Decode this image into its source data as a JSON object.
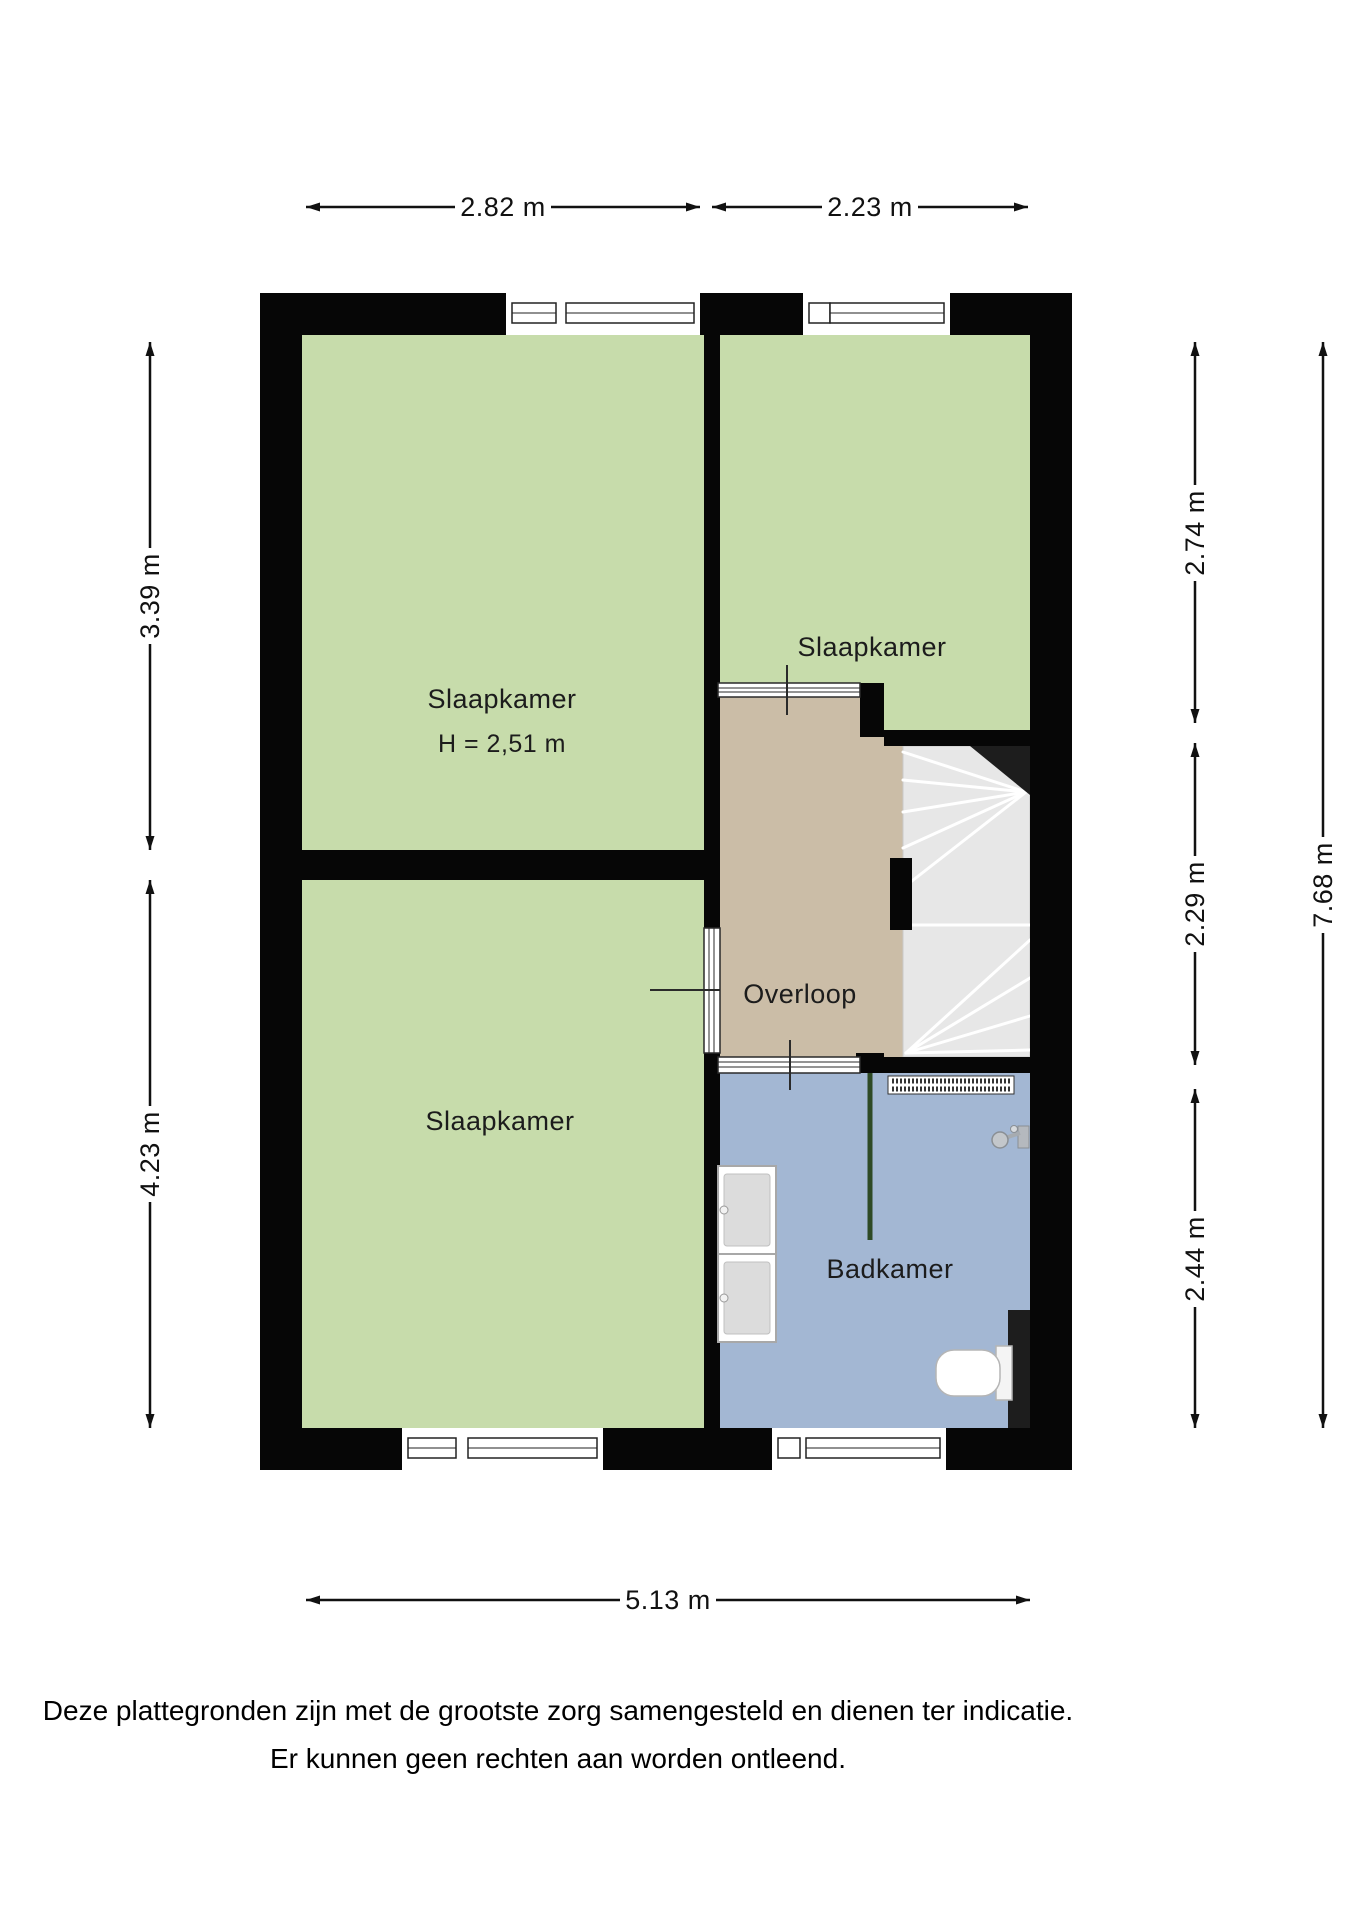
{
  "page": {
    "background_color": "#ffffff"
  },
  "plan": {
    "wall_color": "#060606",
    "rooms": {
      "slaapkamer_top_left": {
        "label": "Slaapkamer",
        "ceiling_height": "H = 2,51 m",
        "floor_color": "#c7dcab"
      },
      "slaapkamer_top_right": {
        "label": "Slaapkamer",
        "floor_color": "#c7dcab"
      },
      "slaapkamer_bottom_left": {
        "label": "Slaapkamer",
        "floor_color": "#c7dcab"
      },
      "overloop": {
        "label": "Overloop",
        "floor_color": "#cbbda7"
      },
      "badkamer": {
        "label": "Badkamer",
        "floor_color": "#a3b7d3"
      }
    },
    "stairs": {
      "floor_color": "#e7e7e7",
      "corner_color": "#1d1d1d"
    },
    "fixtures": {
      "radiator": "radiator",
      "shower_mixer": "shower-mixer",
      "shower_screen_color": "#2e4a25",
      "washbasins": "double-washbasin-cabinet",
      "toilet": "toilet",
      "duct_color": "#1d1d1d"
    },
    "dimensions": {
      "top_left_width": "2.82 m",
      "top_right_width": "2.23 m",
      "left_upper_height": "3.39 m",
      "left_lower_height": "4.23 m",
      "right_upper_height": "2.74 m",
      "right_middle_height": "2.29 m",
      "right_lower_height": "2.44 m",
      "total_width": "5.13 m",
      "total_height": "7.68 m"
    }
  },
  "disclaimer": {
    "line1": "Deze plattegronden zijn met de grootste zorg samengesteld en dienen ter indicatie.",
    "line2": "Er kunnen geen rechten aan worden ontleend."
  }
}
